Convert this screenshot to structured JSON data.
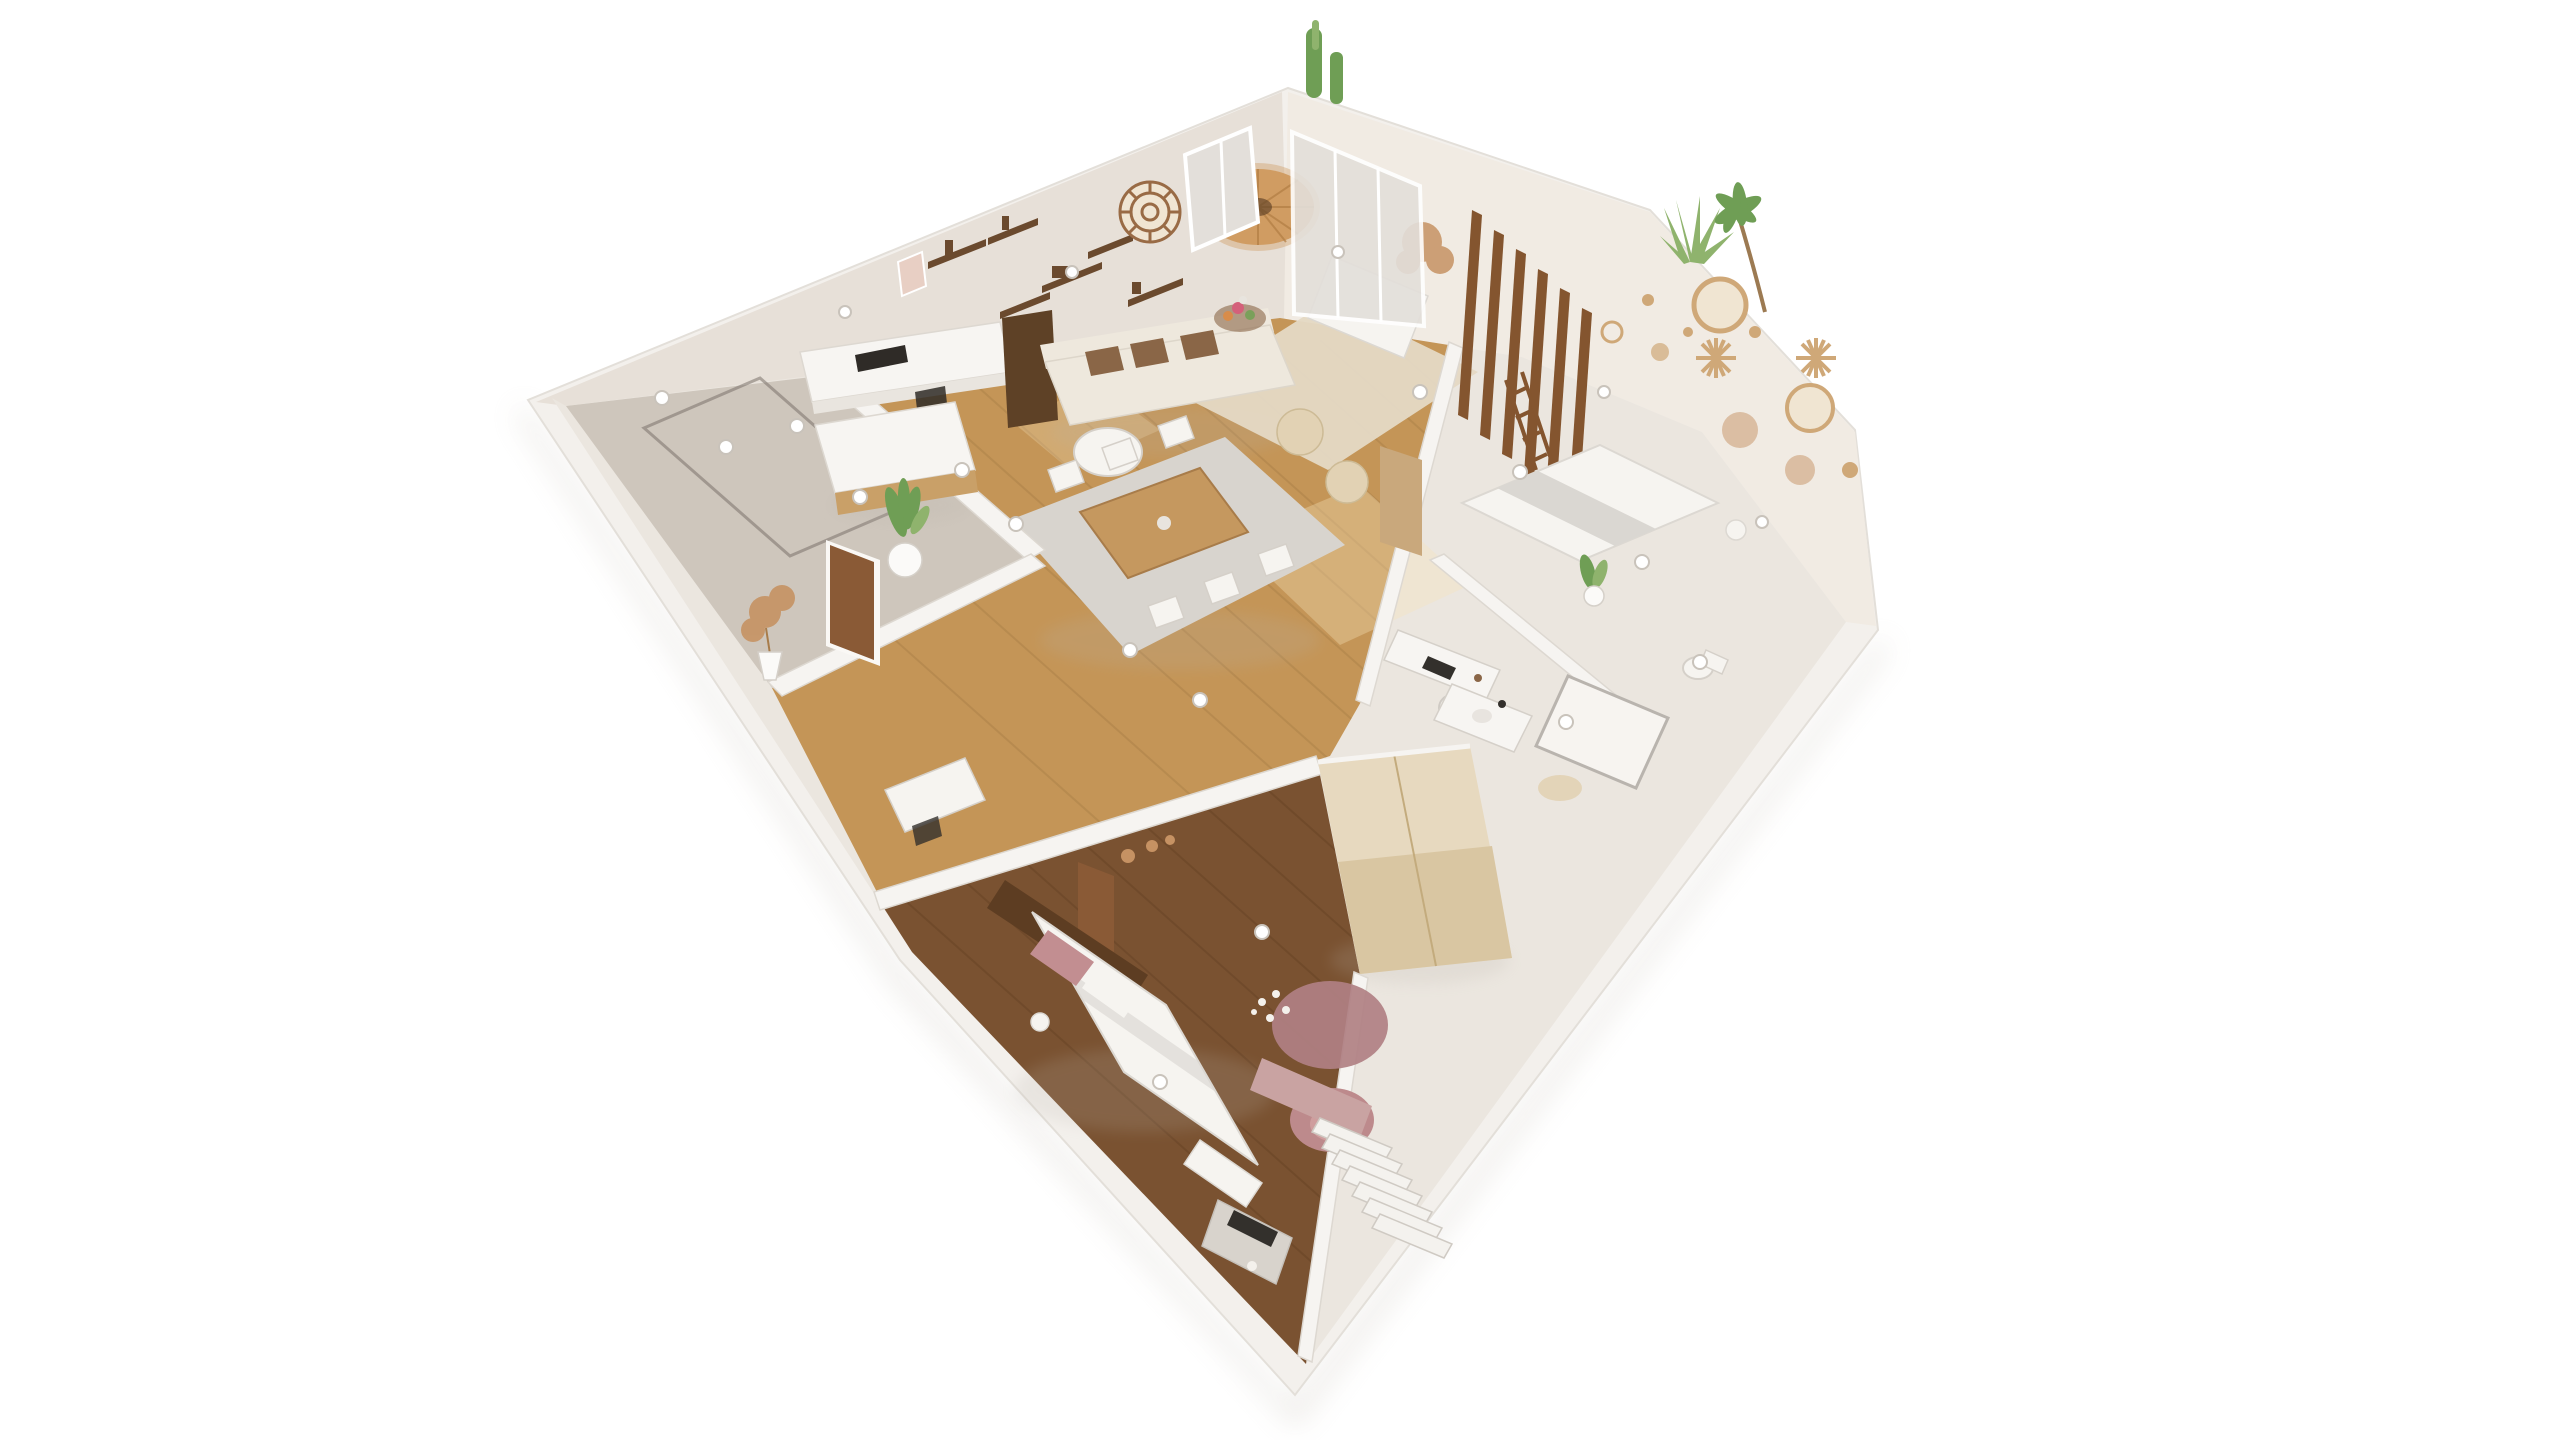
{
  "scene": {
    "kind": "isometric-3d-apartment-floorplan-render",
    "background": "#ffffff",
    "rooms": [
      {
        "name": "entry-hall",
        "floor": "greige-tile"
      },
      {
        "name": "kitchen",
        "floor": "oak-wood"
      },
      {
        "name": "living-room",
        "floor": "oak-wood"
      },
      {
        "name": "dining-area",
        "floor": "oak-wood"
      },
      {
        "name": "master-bedroom",
        "floor": "dark-walnut-wood"
      },
      {
        "name": "second-bedroom",
        "floor": "cream"
      },
      {
        "name": "study-nook",
        "floor": "cream"
      },
      {
        "name": "bathroom",
        "floor": "cream"
      }
    ],
    "objects": {
      "living_room": [
        "sofa-with-brown-cushions",
        "rattan-pendant-lamp",
        "rattan-mandala-wall-decor",
        "window",
        "coffee-table-with-flowers",
        "armchair",
        "daybed",
        "dried-plant",
        "wood-slat-partition",
        "beige-rug",
        "poufs"
      ],
      "kitchen": [
        "wall-shelves",
        "counter-with-cooktop",
        "island",
        "tall-cabinet",
        "potted-plant"
      ],
      "dining_area": [
        "wood-table",
        "white-chairs",
        "grey-rug"
      ],
      "entry_hall": [
        "floor-mat-outline",
        "pampas-plant",
        "front-door",
        "spotlights"
      ],
      "master_bedroom": [
        "bed-white-duvet",
        "pink-pillows",
        "slat-headboard-wall",
        "round-pink-rug",
        "pink-armchair",
        "bench",
        "console-vanity",
        "staircase",
        "pink-accent-wall",
        "wardrobe",
        "daisy-floor-decor"
      ],
      "second_bedroom": [
        "bed",
        "ladder-shelf",
        "potted-plant",
        "side-table"
      ],
      "study_nook": [
        "desk",
        "chair",
        "laptop"
      ],
      "bathroom": [
        "vanity-sink",
        "shower-tray",
        "toilet",
        "bath-mat"
      ],
      "exterior": [
        "cactus-plant",
        "agave-plant",
        "palm-plant"
      ]
    },
    "palette": {
      "page_bg": "#ffffff",
      "building_shadow": "#d9d4ce",
      "wall_top": "#f3f0ec",
      "wall_face_left": "#e7e0d8",
      "wall_face_right": "#f1ebe3",
      "wall_inner": "#f6f4f1",
      "floor_cream": "#ebe6df",
      "floor_entry": "#cec6bc",
      "entry_mat": "#7a7169",
      "floor_wood": "#c49557",
      "plank_line": "#9a7340",
      "sun_patch": "#f6e3bb",
      "floor_bedroom": "#7a5231",
      "bedroom_plank": "#5f3e22",
      "rug_living": "#e4d9c4",
      "rug_dining": "#d8d4ce",
      "rug_pink": "#b08083",
      "sofa_body": "#eee8dd",
      "cushion_brown": "#8a6647",
      "wood_table": "#c5985f",
      "chair_white": "#f6f4f0",
      "pouf": "#e2d2b4",
      "pendant": "#d09c62",
      "pendant_line": "#b27e44",
      "mandala": "#996b45",
      "window_glass": "#e3dfda",
      "shelf_wood": "#6b4a2e",
      "counter_white": "#f7f5f2",
      "counter_face": "#e9e5df",
      "island_wood": "#c9a068",
      "cabinet_dark": "#5e4126",
      "appliance_black": "#2f2b27",
      "door_wood": "#8a5a36",
      "door_tan": "#c9a87c",
      "slat_wood": "#84552f",
      "plant_green": "#6f9e55",
      "plant_green_light": "#8fb36d",
      "plant_dry": "#c69263",
      "pot_white": "#fbfaf8",
      "bed_duvet": "#f6f4f0",
      "duvet_grey": "#dad7d2",
      "pillow_pink": "#c28e91",
      "headboard": "#5d3d22",
      "wardrobe": "#e7d9bf",
      "wardrobe_face": "#d9c6a2",
      "wall_pink": "#c9a3a2",
      "armchair_pink": "#bd8a8c",
      "armchair_pink_seat": "#cf9e9e",
      "stair_white": "#f4f2ee",
      "basket_tan": "#cfa878",
      "basket_fill": "#f0e5d2",
      "console_grey": "#d8d3cc",
      "tv_dark": "#33302c",
      "spot_white": "#ffffff",
      "shadow_soft": "#b9b2a9",
      "flower_pink": "#d4607a",
      "flower_green": "#7aa05a",
      "flower_orange": "#d88c4a",
      "art_pink": "#e8cfc4"
    }
  }
}
